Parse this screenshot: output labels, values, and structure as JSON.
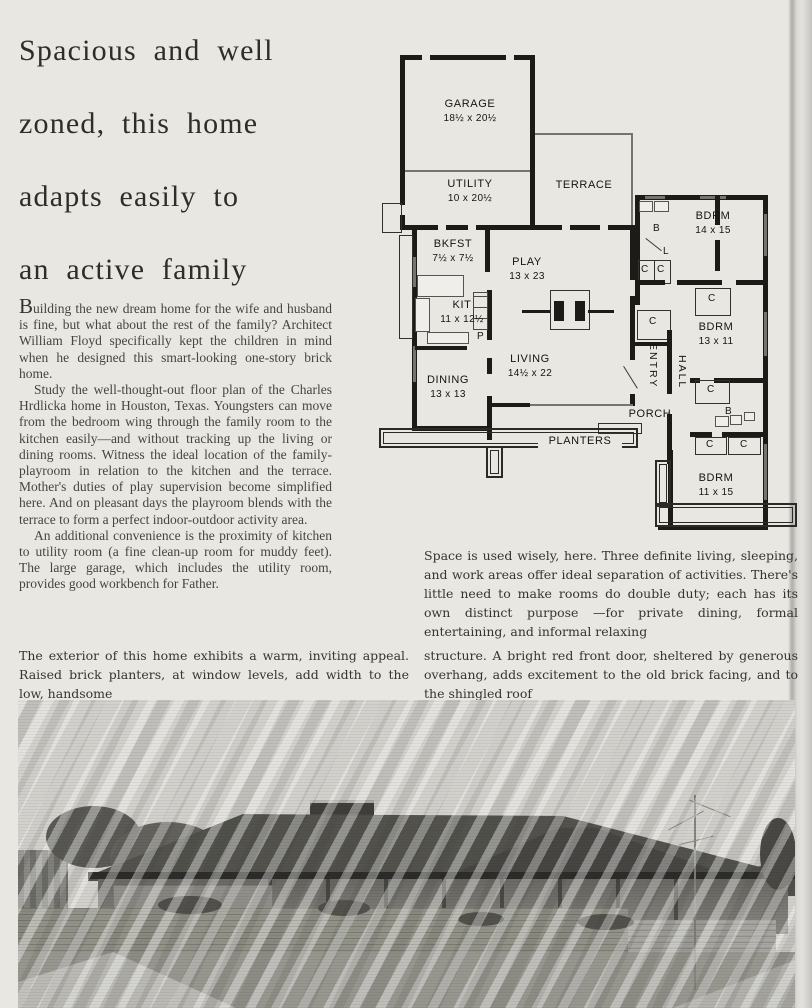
{
  "headline": {
    "lines": [
      "Spacious and well",
      "zoned, this home",
      "adapts easily to",
      "an active family"
    ]
  },
  "body": {
    "p1": "Building the new dream home for the wife and husband is fine, but what about the rest of the family? Architect William Floyd specifically kept the children in mind when he designed this smart-looking one-story brick home.",
    "p2": "Study the well-thought-out floor plan of the Charles Hrdlicka home in Houston, Texas. Youngsters can move from the bedroom wing through the family room to the kitchen easily—and without tracking up the living or dining rooms. Witness the ideal location of the family-playroom in relation to the kitchen and the terrace. Mother's duties of play supervision become simplified here. And on pleasant days the playroom blends with the terrace to form a perfect indoor-outdoor activity area.",
    "p3": "An additional convenience is the proximity of kitchen to utility room (a fine clean-up room for muddy feet). The large garage, which includes the utility room, provides good workbench for Father."
  },
  "captions": {
    "plan": "Space is used wisely, here. Three definite living, sleeping, and work areas offer ideal separation of activities. There's little need to make rooms do double duty; each has its own distinct purpose —for private dining, formal entertaining, and informal relaxing",
    "exterior_left": "The exterior of this home exhibits a warm, inviting appeal. Raised brick planters, at window levels, add width to the low, handsome",
    "exterior_right": "structure. A bright red front door, sheltered by generous overhang, adds excitement to the old brick facing, and to the shingled roof"
  },
  "plan": {
    "rooms": {
      "garage": {
        "name": "GARAGE",
        "dims": "18½ x 20½"
      },
      "utility": {
        "name": "UTILITY",
        "dims": "10 x 20½"
      },
      "terrace": {
        "name": "TERRACE",
        "dims": ""
      },
      "bkfst": {
        "name": "BKFST",
        "dims": "7½ x 7½"
      },
      "play": {
        "name": "PLAY",
        "dims": "13 x 23"
      },
      "kit": {
        "name": "KIT",
        "dims": "11 x 12½"
      },
      "living": {
        "name": "LIVING",
        "dims": "14½ x 22"
      },
      "dining": {
        "name": "DINING",
        "dims": "13 x 13"
      },
      "bdrm1": {
        "name": "BDRM",
        "dims": "14 x 15"
      },
      "bdrm2": {
        "name": "BDRM",
        "dims": "13 x 11"
      },
      "bdrm3": {
        "name": "BDRM",
        "dims": "11 x 15"
      },
      "entry": {
        "name": "ENTRY"
      },
      "hall": {
        "name": "HALL"
      },
      "porch": {
        "name": "PORCH"
      },
      "planters": {
        "name": "PLANTERS"
      }
    },
    "small_labels": {
      "closet": "C",
      "bath": "B",
      "linen": "L",
      "pantry": "P"
    }
  },
  "colors": {
    "paper": "#e9e7e2",
    "ink": "#2e2d2a",
    "plan_wall": "#1c1b18",
    "photo_roof": "#53524d",
    "photo_lawn": "#98978f"
  }
}
